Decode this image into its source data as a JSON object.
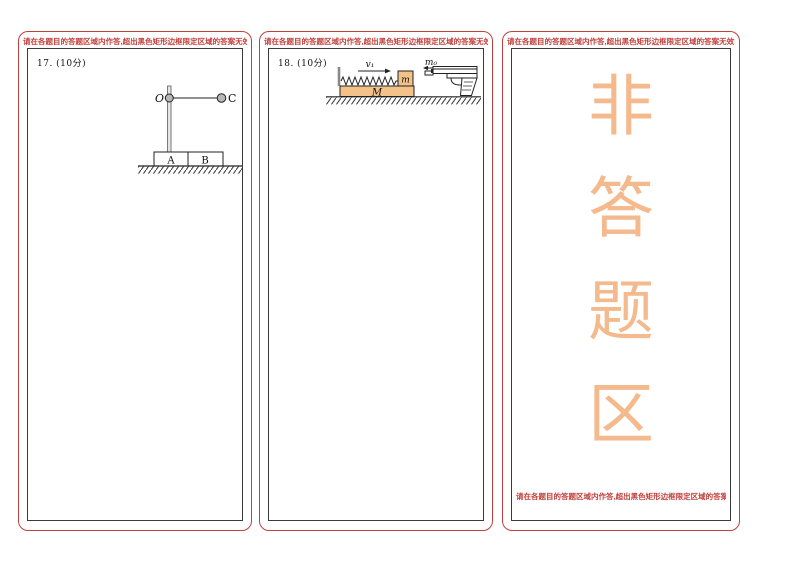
{
  "colors": {
    "frame_red": "#c0403c",
    "warning_text_red": "#c0403c",
    "inner_border_black": "#3a3a3a",
    "big_char_orange": "#f4b98c",
    "block_fill_orange": "#f3c289",
    "metal_gray": "#b8b8b8"
  },
  "warning": "请在各题目的答题区域内作答,超出黑色矩形边框限定区域的答案无效!",
  "col1": {
    "question_label": "17. (10分)",
    "diagram": {
      "pivot_label": "O",
      "ball_label": "C",
      "block_a_label": "A",
      "block_b_label": "B"
    }
  },
  "col2": {
    "question_label": "18. (10分)",
    "diagram": {
      "velocity_label": "v₁",
      "small_block_label": "m",
      "big_block_label": "M",
      "bullet_label": "m₀"
    }
  },
  "col3": {
    "chars": [
      "非",
      "答",
      "题",
      "区"
    ],
    "bottom_warning": "请在各题目的答题区域内作答,超出黑色矩形边框限定区域的答案无效!"
  }
}
